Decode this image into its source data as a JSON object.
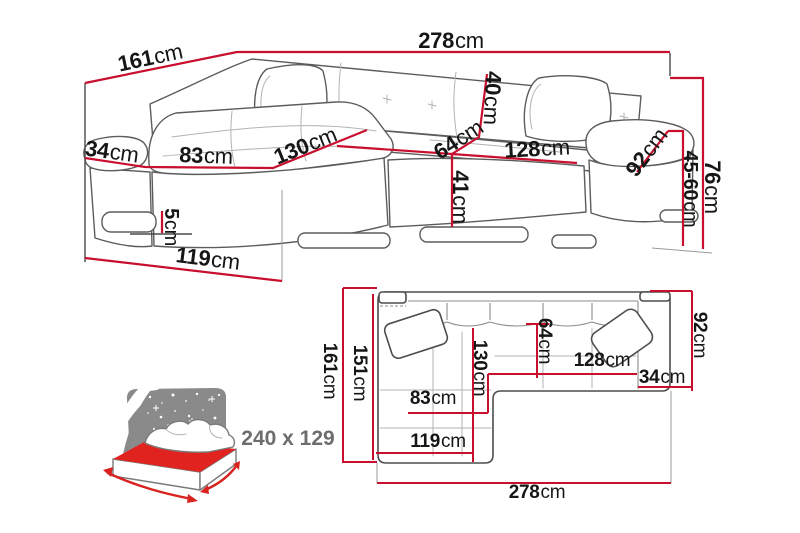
{
  "colors": {
    "dimension_red": "#c8102e",
    "sofa_outline_gray": "#5c5c5c",
    "text_black": "#161616",
    "bed_headboard_gray": "#8a8a8a",
    "bed_mattress_red": "#e0231f",
    "bed_label_gray": "#6d6d6d",
    "background": "#ffffff"
  },
  "perspective_view": {
    "description": "corner-sofa-front-perspective",
    "dimensions": [
      {
        "id": "left-side-depth",
        "value": "161",
        "unit": "cm"
      },
      {
        "id": "total-width",
        "value": "278",
        "unit": "cm"
      },
      {
        "id": "armrest-top-width",
        "value": "34",
        "unit": "cm"
      },
      {
        "id": "chaise-front-width",
        "value": "83",
        "unit": "cm"
      },
      {
        "id": "chaise-seat-length",
        "value": "130",
        "unit": "cm"
      },
      {
        "id": "backrest-height",
        "value": "40",
        "unit": "cm"
      },
      {
        "id": "seat-depth",
        "value": "64",
        "unit": "cm"
      },
      {
        "id": "seat-width",
        "value": "128",
        "unit": "cm"
      },
      {
        "id": "armrest-depth",
        "value": "92",
        "unit": "cm"
      },
      {
        "id": "total-height",
        "value": "76",
        "unit": "cm"
      },
      {
        "id": "seat-height-range",
        "value": "45-60",
        "unit": "cm"
      },
      {
        "id": "base-height",
        "value": "41",
        "unit": "cm"
      },
      {
        "id": "leg-height",
        "value": "5",
        "unit": "cm"
      },
      {
        "id": "chaise-base-length",
        "value": "119",
        "unit": "cm"
      }
    ]
  },
  "plan_view": {
    "description": "corner-sofa-top-plan",
    "dimensions": [
      {
        "id": "total-depth-left",
        "value": "161",
        "unit": "cm"
      },
      {
        "id": "chaise-length",
        "value": "151",
        "unit": "cm"
      },
      {
        "id": "chaise-inner-length",
        "value": "130",
        "unit": "cm"
      },
      {
        "id": "seat-depth",
        "value": "64",
        "unit": "cm"
      },
      {
        "id": "chaise-width",
        "value": "83",
        "unit": "cm"
      },
      {
        "id": "chaise-outer-width",
        "value": "119",
        "unit": "cm"
      },
      {
        "id": "seat-width",
        "value": "128",
        "unit": "cm"
      },
      {
        "id": "armrest-width",
        "value": "34",
        "unit": "cm"
      },
      {
        "id": "right-side-depth",
        "value": "92",
        "unit": "cm"
      },
      {
        "id": "total-width",
        "value": "278",
        "unit": "cm"
      }
    ]
  },
  "bed_function": {
    "sleeping_area_label": "240 x 129"
  }
}
